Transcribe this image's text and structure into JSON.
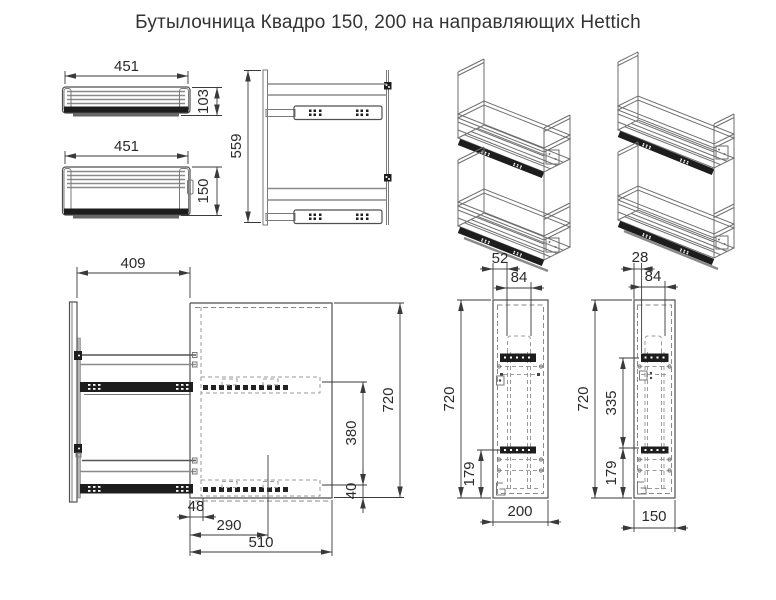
{
  "title": "Бутылочница Квадро 150, 200 на направляющих Hettich",
  "colors": {
    "line": "#4f4f4f",
    "dark": "#1d1d1d",
    "ghost": "#9a9a9a",
    "dim_text": "#2b2b2b",
    "background": "#ffffff"
  },
  "views": {
    "basket_small": {
      "width": "451",
      "height": "103"
    },
    "basket_large": {
      "width": "451",
      "height": "150"
    },
    "plan": {
      "depth": "559"
    },
    "side": {
      "pullout": "409",
      "height": "720",
      "rail_spacing": "380",
      "rail_bottom_offset": "40",
      "front_offset": "48",
      "inner_depth": "290",
      "cabinet_depth": "510"
    },
    "front_200": {
      "side_offset": "52",
      "unit_width": "84",
      "height": "720",
      "rail_height": "179",
      "cabinet_width": "200"
    },
    "front_150": {
      "side_offset": "28",
      "unit_width": "84",
      "height": "720",
      "rail_spacing": "335",
      "rail_height": "179",
      "cabinet_width": "150"
    }
  }
}
